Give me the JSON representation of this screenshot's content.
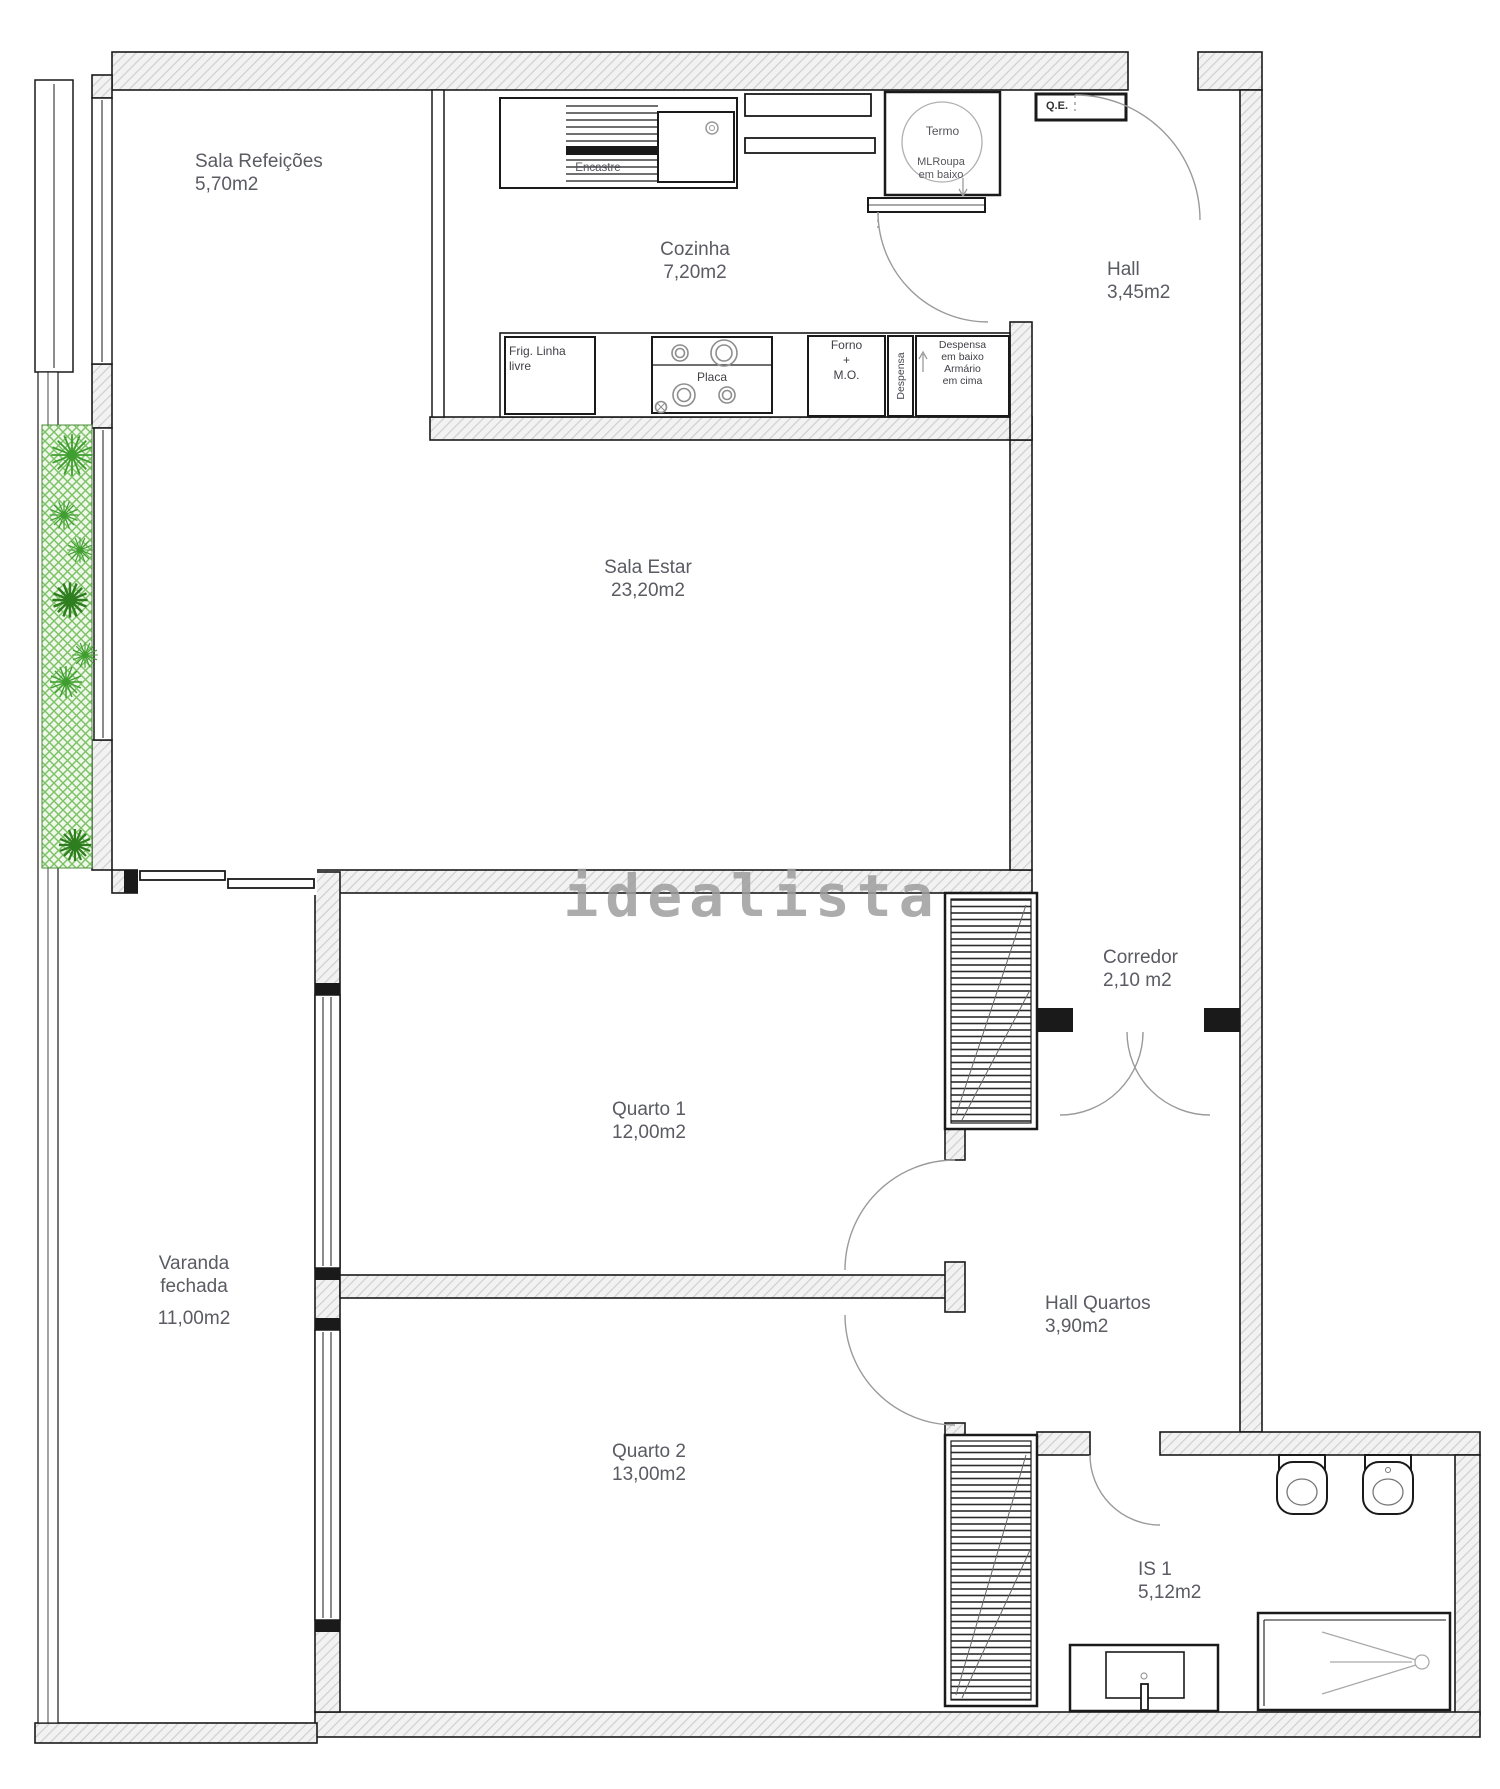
{
  "watermark": "idealista",
  "rooms": {
    "sala_refeicoes": {
      "name": "Sala Refeições",
      "area": "5,70m2"
    },
    "cozinha": {
      "name": "Cozinha",
      "area": "7,20m2"
    },
    "hall": {
      "name": "Hall",
      "area": "3,45m2"
    },
    "sala_estar": {
      "name": "Sala Estar",
      "area": "23,20m2"
    },
    "corredor": {
      "name": "Corredor",
      "area": "2,10 m2"
    },
    "quarto1": {
      "name": "Quarto 1",
      "area": "12,00m2"
    },
    "varanda": {
      "name_line1": "Varanda",
      "name_line2": "fechada",
      "area": "11,00m2"
    },
    "hall_quartos": {
      "name": "Hall Quartos",
      "area": "3,90m2"
    },
    "quarto2": {
      "name": "Quarto 2",
      "area": "13,00m2"
    },
    "is1": {
      "name": "IS 1",
      "area": "5,12m2"
    }
  },
  "kitchen": {
    "encastre": "Encastre",
    "frig_line1": "Frig. Linha",
    "frig_line2": "livre",
    "placa": "Placa",
    "forno_line1": "Forno",
    "forno_line2": "+",
    "forno_line3": "M.O.",
    "despensa_vertical": "Despensa",
    "cabinet_line1": "Despensa",
    "cabinet_line2": "em baixo",
    "cabinet_line3": "Armário",
    "cabinet_line4": "em cima"
  },
  "utility": {
    "termo": "Termo",
    "ml_line1": "MLRoupa",
    "ml_line2": "em baixo",
    "qe": "Q.E."
  },
  "colors": {
    "wall_line": "#1a1a1a",
    "wall_hatch": "#cfcfcf",
    "label_text": "#5a5b63",
    "door_arc": "#9a9a9a",
    "plant_green": "#3f9e2f",
    "watermark_gray": "#9e9e9e"
  }
}
